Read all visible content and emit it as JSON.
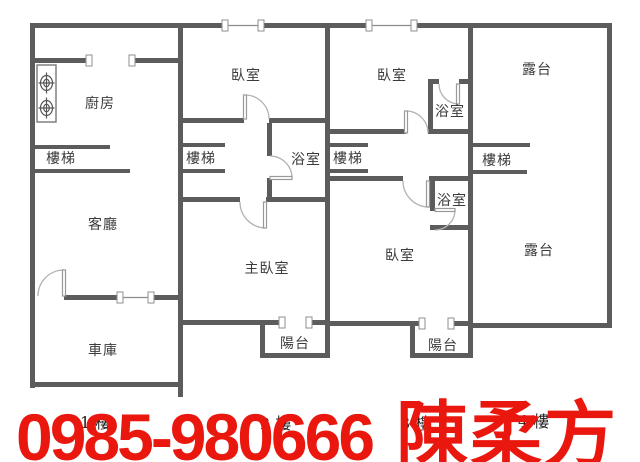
{
  "image_type": "real-estate floor plan, 4 stacked floors drawn side by side",
  "colors": {
    "wall": "#5c5c5c",
    "door_arc": "#b3b3b3",
    "room_label": "#3b3b3b",
    "floor_tag": "#1f1f1f",
    "overlay_red": "#e9170e",
    "background": "#ffffff"
  },
  "rooms": {
    "kitchen": "廚房",
    "living": "客廳",
    "garage": "車庫",
    "master_bedroom": "主臥室",
    "bedroom_f2": "臥室",
    "bedroom_f3_top": "臥室",
    "bedroom_f3_bottom": "臥室",
    "terrace_top": "露台",
    "terrace_bottom": "露台",
    "stairs_f1": "樓梯",
    "stairs_f2": "樓梯",
    "stairs_f3": "樓梯",
    "stairs_f4": "樓梯",
    "bath_f2": "浴室",
    "bath_f3_top": "浴室",
    "bath_f3_bottom": "浴室",
    "balcony_f2": "陽台",
    "balcony_f3": "陽台"
  },
  "floor_tags": {
    "f1": "1 樓",
    "f2": "2 樓",
    "f3": "3 樓",
    "f4": "4 樓"
  },
  "overlay": {
    "phone": "0985-980666",
    "agent_name": "陳柔方"
  }
}
